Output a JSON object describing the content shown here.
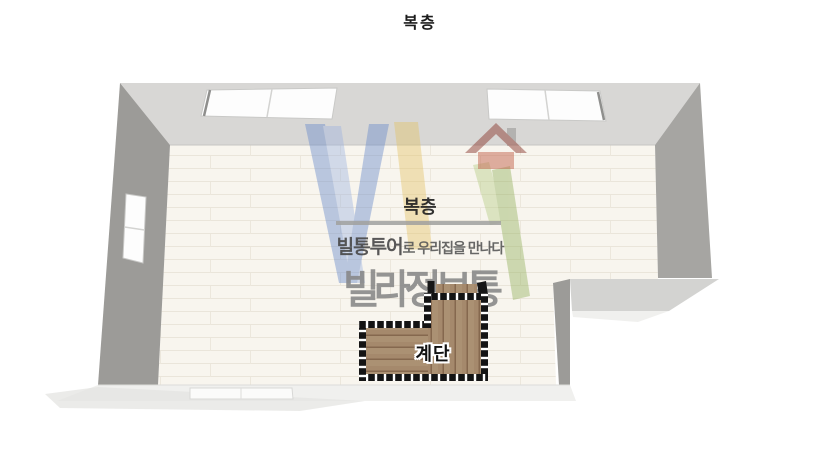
{
  "page": {
    "title": "복층"
  },
  "watermark": {
    "room_label": "복층",
    "tagline_brand": "빌통투어",
    "tagline_suffix": "로 우리집을 만나다",
    "brand": "빌라정보통",
    "logo": {
      "blue": "#6487ca",
      "light_blue": "#9db3e0",
      "yellow": "#e3c365",
      "green": "#8fae57",
      "light_green": "#b5cc83",
      "roof_red": "#8d3f36",
      "house_red": "#c4654f",
      "chimney_gray": "#8f8f8d"
    }
  },
  "stairs": {
    "label": "계단"
  },
  "palette": {
    "wall_top": "#d8d7d5",
    "wall_left": "#9c9b98",
    "wall_right": "#a6a5a2",
    "notch_top": "#d3d3d1",
    "notch_side": "#9c9b98",
    "wall_bottom": "#f0f0ee",
    "floor_base": "#f8f5ee",
    "shadow": "#e4e4e2",
    "window_white": "#fdfdfd",
    "railing_black": "#161616"
  }
}
